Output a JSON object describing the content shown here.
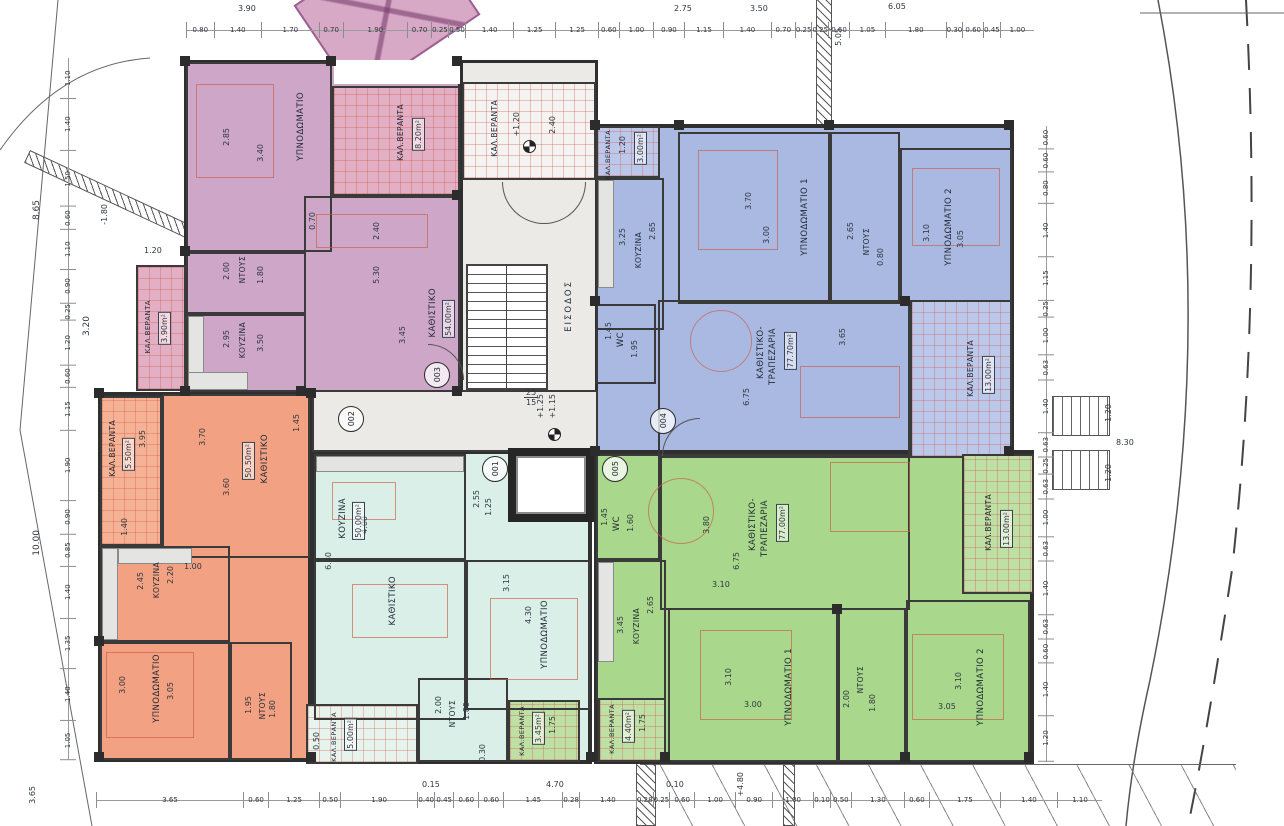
{
  "core": {
    "entrance": "ΕΙΣΟΔΟΣ",
    "veranda": "ΚΑΛ.ΒΕΡΑΝΤΑ"
  },
  "units": {
    "u1": "001",
    "u2": "002",
    "u3": "003",
    "u4": "004",
    "u5": "005"
  },
  "rooms": {
    "p_bed": {
      "name": "ΥΠΝΟΔΩΜΑΤΙΟ",
      "w": "2.85",
      "h": "3.40"
    },
    "p_shower": {
      "name": "ΝΤΟΥΣ",
      "w": "2.00",
      "h": "1.80"
    },
    "p_hall": {
      "w": "0.70",
      "h": "2.40"
    },
    "p_ver1": {
      "name": "ΚΑΛ.ΒΕΡΑΝΤΑ",
      "area": "8.20m²"
    },
    "p_kitchen": {
      "name": "ΚΟΥΖΙΝΑ",
      "w": "2.95",
      "h": "3.50"
    },
    "p_living": {
      "name": "ΚΑΘΙΣΤΙΚΟ",
      "area": "54.00m²",
      "w": "5.30",
      "h": "3.45"
    },
    "p_ver2": {
      "name": "ΚΑΛ.ΒΕΡΑΝΤΑ",
      "area": "3.90m²",
      "w": "1.20"
    },
    "b_ver1": {
      "name": "ΚΑΛ.ΒΕΡΑΝΤΑ",
      "area": "3.00m²",
      "w": "1.20"
    },
    "b_kitchen": {
      "name": "ΚΟΥΖΙΝΑ",
      "w": "3.25",
      "h": "2.65"
    },
    "b_bed1": {
      "name": "ΥΠΝΟΔΩΜΑΤΙΟ 1",
      "w": "3.70",
      "h": "3.00"
    },
    "b_shower": {
      "name": "ΝΤΟΥΣ",
      "w": "2.65",
      "h": "0.80"
    },
    "b_bed2": {
      "name": "ΥΠΝΟΔΩΜΑΤΙΟ 2",
      "w": "3.10",
      "h": "3.05"
    },
    "b_wc": {
      "name": "WC",
      "w": "1.45",
      "h": "1.95"
    },
    "b_living": {
      "name1": "ΚΑΘΙΣΤΙΚΟ-",
      "name2": "ΤΡΑΠΕΖΑΡΙΑ",
      "area": "77.70m²",
      "w": "6.75",
      "h": "3.65"
    },
    "b_ver2": {
      "name": "ΚΑΛ.ΒΕΡΑΝΤΑ",
      "area": "13.00m²"
    },
    "o_ver": {
      "name": "ΚΑΛ.ΒΕΡΑΝΤΑ",
      "area": "5.50m²",
      "w": "1.40",
      "h": "3.95"
    },
    "o_living": {
      "name": "ΚΑΘΙΣΤΙΚΟ",
      "area": "50.50m²",
      "w": "3.70",
      "h": "3.60",
      "extra": "1.45"
    },
    "o_kitchen": {
      "name": "ΚΟΥΖΙΝΑ",
      "w": "2.45",
      "h": "2.20",
      "extra": "1.00"
    },
    "o_bed": {
      "name": "ΥΠΝΟΔΩΜΑΤΙΟ",
      "w": "3.00",
      "h": "3.05"
    },
    "o_shower": {
      "name": "ΝΤΟΥΣ",
      "w": "1.95",
      "h": "1.80"
    },
    "t_kitchen": {
      "name": "ΚΟΥΖΙΝΑ",
      "w": "6.30",
      "h": "4.00"
    },
    "t_living": {
      "name": "ΚΑΘΙΣΤΙΚΟ",
      "area": "50.00m²",
      "w": "2.55",
      "h": "1.25"
    },
    "t_bed": {
      "name": "ΥΠΝΟΔΩΜΑΤΙΟ",
      "w": "4.30",
      "h": "3.15"
    },
    "t_shower": {
      "name": "ΝΤΟΥΣ",
      "w": "2.00",
      "h": "1.80"
    },
    "t_ver": {
      "name": "ΚΑΛ.ΒΕΡΑΝΤΑ",
      "area": "5.00m²"
    },
    "g_wc": {
      "name": "WC",
      "w": "1.60",
      "h": "1.45"
    },
    "g_living": {
      "name1": "ΚΑΘΙΣΤΙΚΟ-",
      "name2": "ΤΡΑΠΕΖΑΡΙΑ",
      "area": "77.00m²",
      "w": "6.75",
      "h": "3.80",
      "extra": "3.10"
    },
    "g_kitchen": {
      "name": "ΚΟΥΖΙΝΑ",
      "w": "3.45",
      "h": "2.65"
    },
    "g_bed1": {
      "name": "ΥΠΝΟΔΩΜΑΤΙΟ 1",
      "w": "3.10",
      "h": "3.00"
    },
    "g_shower": {
      "name": "ΝΤΟΥΣ",
      "w": "2.00",
      "h": "1.80"
    },
    "g_bed2": {
      "name": "ΥΠΝΟΔΩΜΑΤΙΟ 2",
      "w": "3.10",
      "h": "3.05"
    },
    "g_ver1": {
      "name": "ΚΑΛ.ΒΕΡΑΝΤΑ",
      "area": "3.45m²",
      "w": "1.75"
    },
    "g_ver2": {
      "name": "ΚΑΛ.ΒΕΡΑΝΤΑ",
      "area": "4.40m²",
      "w": "1.75"
    },
    "g_ver3": {
      "name": "ΚΑΛ.ΒΕΡΑΝΤΑ",
      "area": "13.00m²"
    }
  },
  "site": {
    "labels": [
      "8.65",
      "3.20",
      "-1.80",
      "10.00",
      "3.90",
      "2.75",
      "3.50",
      "5.05",
      "6.05",
      "8.30",
      "1.20",
      "1.20",
      "3.65",
      "4.70",
      "0.15",
      "0.10",
      "+4.80",
      "0.50",
      "0.30",
      "+1.20",
      "2.40",
      "+1.25",
      "+1.15",
      "25",
      "15"
    ]
  },
  "rails": {
    "top": [
      "0.80",
      "1.40",
      "1.70",
      "0.70",
      "1.90",
      "0.70",
      "0.25",
      "0.50",
      "1.40",
      "1.25",
      "1.25",
      "0.60",
      "1.00",
      "0.90",
      "1.15",
      "1.40",
      "0.70",
      "0.25",
      "0.25",
      "0.60",
      "1.05",
      "1.80",
      "0.30",
      "0.60",
      "0.45",
      "1.00"
    ],
    "bottom": [
      "3.65",
      "0.60",
      "1.25",
      "0.50",
      "1.90",
      "0.40",
      "0.45",
      "0.60",
      "0.60",
      "1.45",
      "0.28",
      "1.40",
      "0.28",
      "0.25",
      "0.60",
      "1.00",
      "0.90",
      "1.00",
      "0.10",
      "0.50",
      "1.30",
      "0.60",
      "1.75",
      "1.40",
      "1.10"
    ],
    "left": [
      "1.10",
      "1.40",
      "1.50",
      "0.60",
      "1.10",
      "0.90",
      "0.25",
      "1.20",
      "0.60",
      "1.15",
      "1.90",
      "0.90",
      "0.85",
      "1.40",
      "1.35",
      "1.40",
      "1.05"
    ],
    "right": [
      "0.60",
      "0.60",
      "0.80",
      "1.40",
      "1.15",
      "0.25",
      "1.00",
      "0.63",
      "1.40",
      "0.63",
      "0.25",
      "0.63",
      "1.00",
      "0.63",
      "1.40",
      "0.63",
      "0.60",
      "1.40",
      "1.20"
    ]
  },
  "colors": {
    "purple": "#cda6c8",
    "blue": "#a9b9e2",
    "orange": "#f2a183",
    "teal": "#d9efe8",
    "green": "#a9d78b",
    "wall": "#2f2f2f"
  }
}
